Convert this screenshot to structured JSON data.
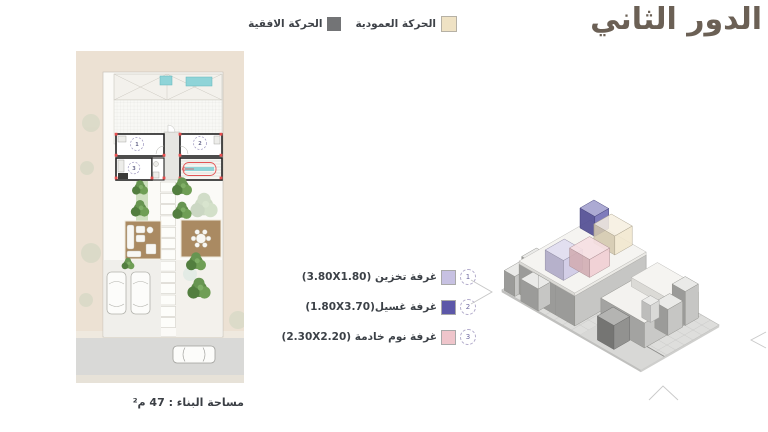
{
  "title": "الدور الثاني",
  "legend": {
    "vertical": {
      "label": "الحركة العمودية",
      "color": "#efe2c4"
    },
    "horizontal": {
      "label": "الحركة الافقية",
      "color": "#737476"
    }
  },
  "rooms": [
    {
      "num": "1",
      "name": "غرفة تخزين",
      "dims": "(3.80X1.80)",
      "color": "#c7c1e2"
    },
    {
      "num": "2",
      "name": "غرفة غسيل",
      "dims": "(1.80X3.70)",
      "color": "#5c57a8"
    },
    {
      "num": "3",
      "name": "غرفة نوم خادمة",
      "dims": "(2.30X2.20)",
      "color": "#efc5cb"
    }
  ],
  "footer": {
    "building_area": "مساحة البناء : 47 م²"
  }
}
